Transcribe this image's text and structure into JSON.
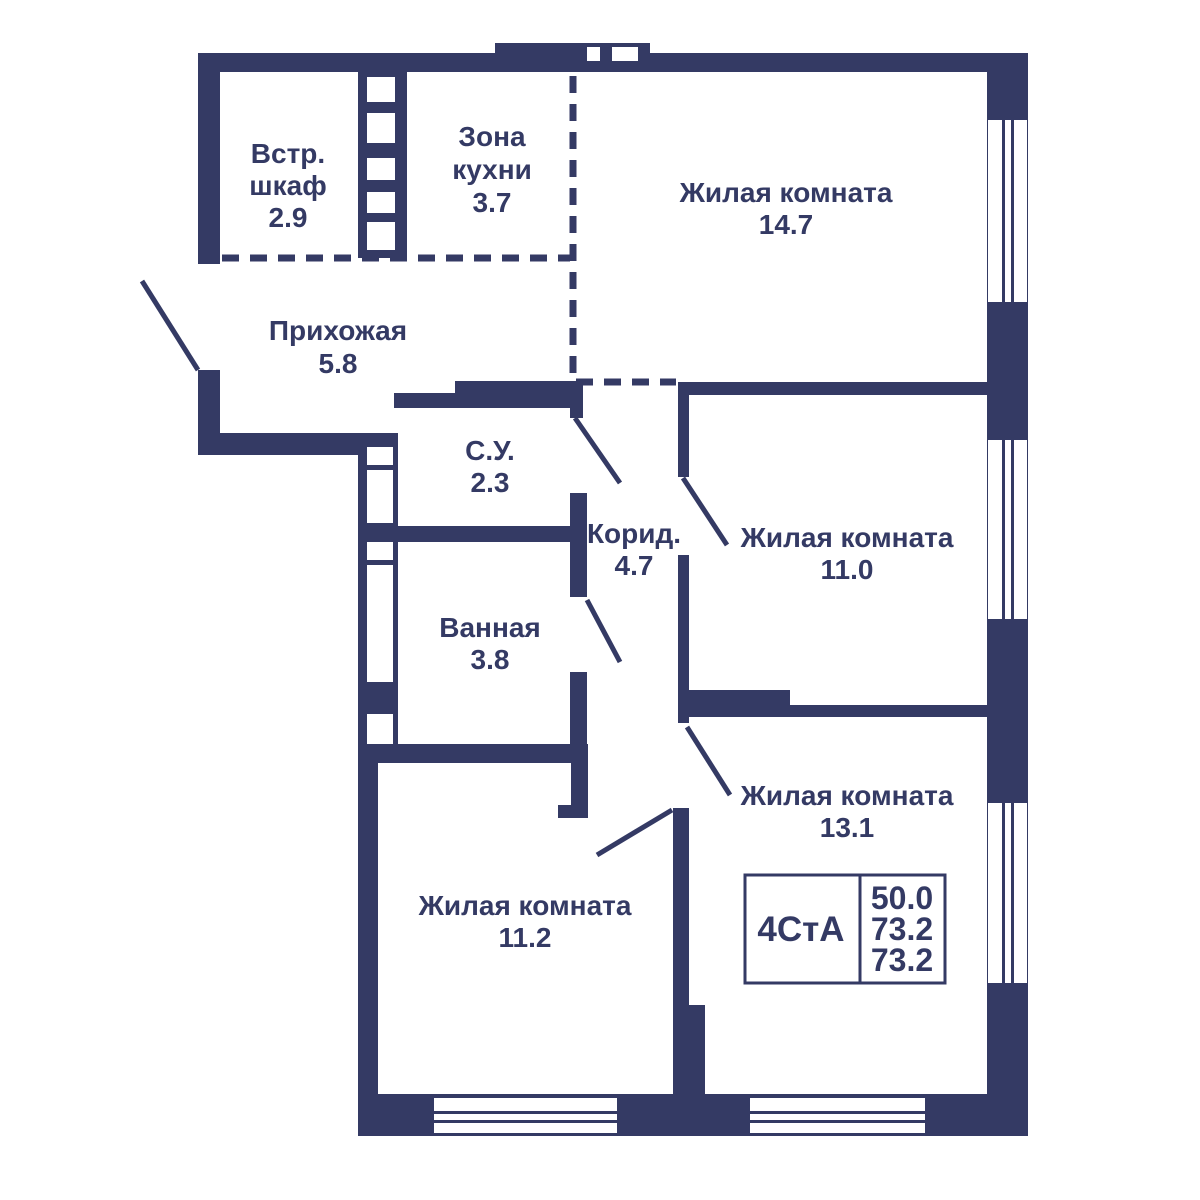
{
  "plan": {
    "title": "apartment-floor-plan",
    "colors": {
      "wall": "#343A64",
      "background": "#FFFFFF"
    },
    "unit_label": "4СтА",
    "area_values": [
      "50.0",
      "73.2",
      "73.2"
    ]
  },
  "rooms": {
    "wardrobe": {
      "line1": "Встр.",
      "line2": "шкаф",
      "area": "2.9"
    },
    "kitchen": {
      "line1": "Зона",
      "line2": "кухни",
      "area": "3.7"
    },
    "living1": {
      "name": "Жилая комната",
      "area": "14.7"
    },
    "hallway": {
      "name": "Прихожая",
      "area": "5.8"
    },
    "wc": {
      "name": "С.У.",
      "area": "2.3"
    },
    "corridor": {
      "name": "Корид.",
      "area": "4.7"
    },
    "living2": {
      "name": "Жилая комната",
      "area": "11.0"
    },
    "bathroom": {
      "name": "Ванная",
      "area": "3.8"
    },
    "living3": {
      "name": "Жилая комната",
      "area": "13.1"
    },
    "living4": {
      "name": "Жилая комната",
      "area": "11.2"
    }
  }
}
